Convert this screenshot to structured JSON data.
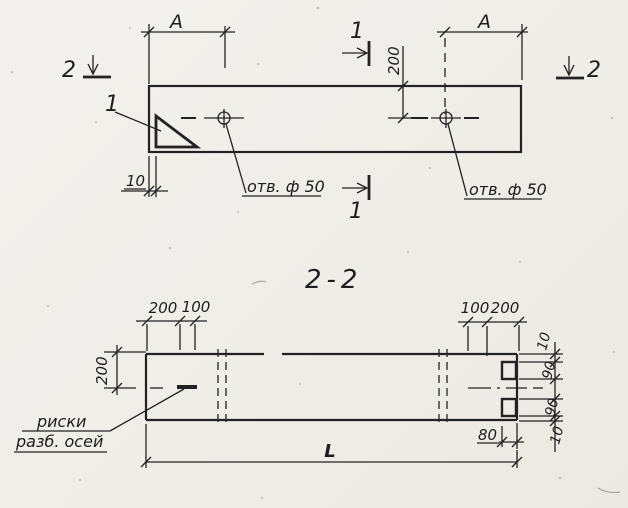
{
  "drawing": {
    "plan_view": {
      "section_marker_1_top": "1",
      "section_marker_1_bottom": "1",
      "section_marker_2_left": "2",
      "section_marker_2_right": "2",
      "detail_callout": "1",
      "dim_a_left": "A",
      "dim_a_right": "A",
      "dim_hole_offset": "200",
      "dim_edge_gap": "10",
      "hole_label_left": "отв. ф 50",
      "hole_label_right": "отв. ф 50"
    },
    "section_view": {
      "title": "2-2",
      "dim_top_left_200": "200",
      "dim_top_left_100": "100",
      "dim_top_right_100": "100",
      "dim_top_right_200": "200",
      "dim_height": "200",
      "dim_chain": [
        "10",
        "90",
        "90",
        "10"
      ],
      "dim_notch": "80",
      "dim_length": "L",
      "axis_note_line1": "риски",
      "axis_note_line2": "разб. осей"
    },
    "colors": {
      "paper": "#f2f0ec",
      "ink": "#222222"
    }
  }
}
